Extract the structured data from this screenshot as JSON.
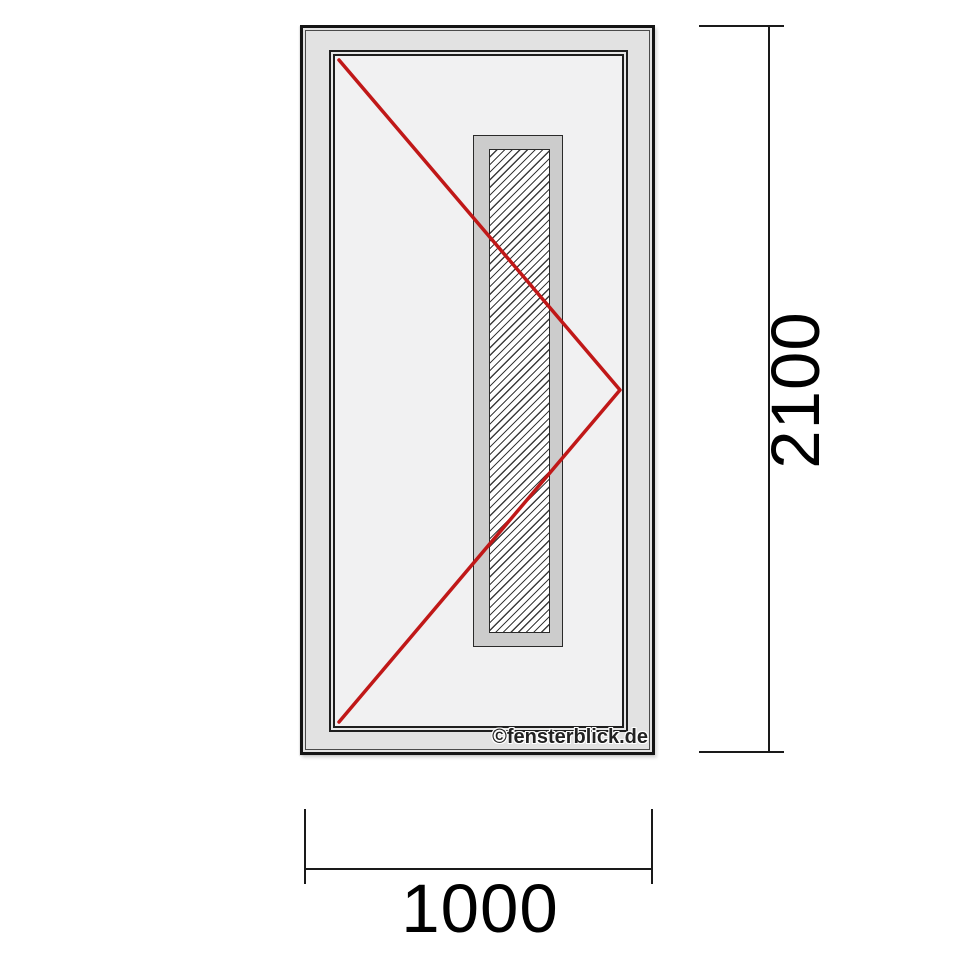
{
  "drawing": {
    "subject": "front-door-technical-drawing",
    "watermark": "©fensterblick.de",
    "colors": {
      "outline_dark": "#1a1a1a",
      "frame_gray": "#e2e2e2",
      "leaf_surface_gray": "#f1f1f2",
      "glass_frame_gray": "#cccccc",
      "glass_hatch": "#3c3c3c",
      "opening_indicator_red": "#c01818",
      "dimension_text": "#000000",
      "background": "#ffffff"
    }
  },
  "dimensions": {
    "height_label": "2100",
    "width_label": "1000"
  }
}
